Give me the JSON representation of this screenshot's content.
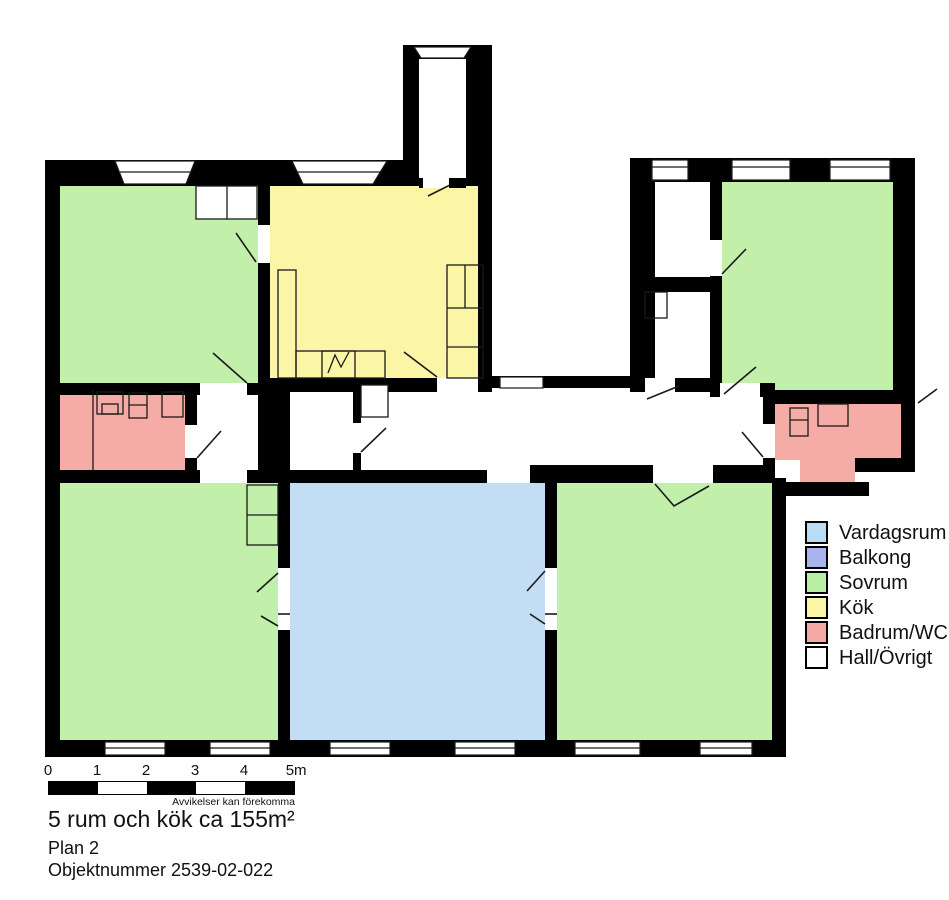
{
  "title_block": {
    "line1": "5 rum och kök ca 155m²",
    "line2": "Plan 2",
    "line3": "Objektnummer 2539-02-022"
  },
  "scale_bar": {
    "labels": [
      "0",
      "1",
      "2",
      "3",
      "4",
      "5m"
    ],
    "disclaimer": "Avvikelser kan förekomma"
  },
  "legend": {
    "items": [
      {
        "label": "Vardagsrum",
        "color": "#b9dcf3"
      },
      {
        "label": "Balkong",
        "color": "#abb3ef"
      },
      {
        "label": "Sovrum",
        "color": "#b8efa3"
      },
      {
        "label": "Kök",
        "color": "#fbf6a3"
      },
      {
        "label": "Badrum/WC",
        "color": "#f4a9a4"
      },
      {
        "label": "Hall/Övrigt",
        "color": "#ffffff"
      }
    ]
  },
  "colors": {
    "vardagsrum": "#c2ddf4",
    "balkong": "#abb3ef",
    "sovrum": "#c2f0ab",
    "kok": "#fbf6a6",
    "badrum": "#f5aba6",
    "hall": "#ffffff",
    "wall": "#000000"
  },
  "floor_plan": {
    "rooms": [
      {
        "area": "top-left",
        "type": "Sovrum"
      },
      {
        "area": "top-center",
        "type": "Kök"
      },
      {
        "area": "top-protrusion",
        "type": "Hall/Övrigt"
      },
      {
        "area": "top-right-closets",
        "type": "Hall/Övrigt"
      },
      {
        "area": "top-right",
        "type": "Sovrum"
      },
      {
        "area": "middle-left",
        "type": "Badrum/WC"
      },
      {
        "area": "middle-corridor",
        "type": "Hall/Övrigt"
      },
      {
        "area": "middle-right",
        "type": "Badrum/WC"
      },
      {
        "area": "bottom-left",
        "type": "Sovrum"
      },
      {
        "area": "bottom-center",
        "type": "Vardagsrum"
      },
      {
        "area": "bottom-right",
        "type": "Sovrum"
      }
    ]
  }
}
